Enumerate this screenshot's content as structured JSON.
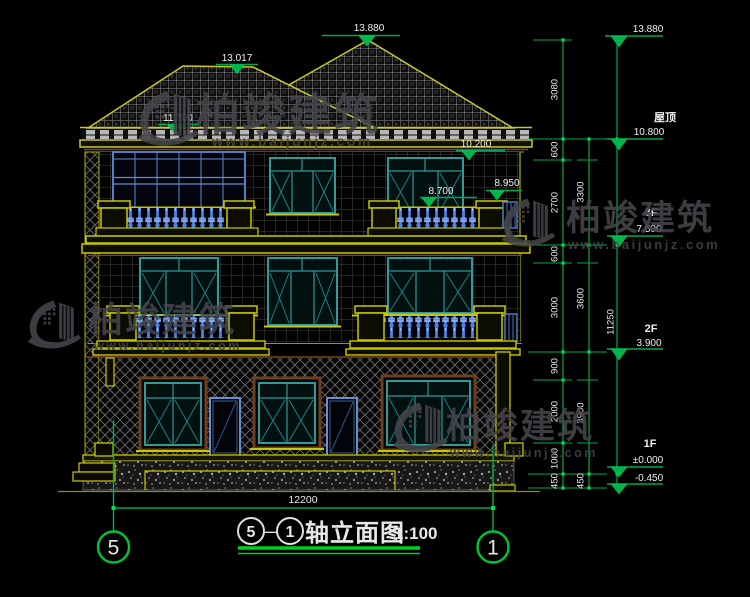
{
  "watermark": {
    "brand": "柏竣建筑",
    "url": "www.baijunjz.com"
  },
  "title": {
    "axis_from": "5",
    "dash": "—",
    "axis_to": "1",
    "name": "轴立面图",
    "scale": "1:100"
  },
  "axes": {
    "left": "5",
    "right": "1"
  },
  "dimensions": {
    "overall_width": "12200",
    "total_height": "11250",
    "col1": [
      "3080",
      "600",
      "2700",
      "600",
      "3000",
      "900",
      "2000",
      "1000",
      "450"
    ],
    "col2": [
      "3300",
      "3600",
      "3900",
      "450"
    ]
  },
  "levels": {
    "ridge_high": "13.880",
    "ridge_low": "13.017",
    "eave": "11.700",
    "lintel": "10.200",
    "rail": "8.950",
    "balcony": "8.700",
    "top_right": "13.880",
    "roof_label": "屋顶",
    "roof_value": "10.800",
    "f3_label": "3F",
    "f3_value": "7.500",
    "f2_label": "2F",
    "f2_value": "3.900",
    "f1_label": "1F",
    "f1_value": "±0.000",
    "ground": "-0.450"
  }
}
